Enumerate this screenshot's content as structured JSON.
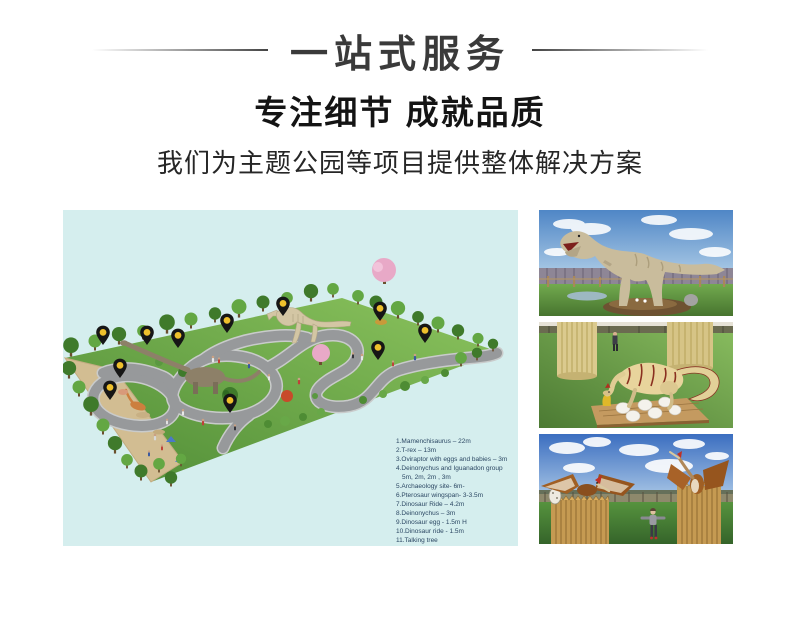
{
  "header": {
    "banner_title": "一站式服务",
    "heading": "专注细节 成就品质",
    "subheading": "我们为主题公园等项目提供整体解决方案"
  },
  "park_map": {
    "legend_items": [
      "1.Mamenchisaurus – 22m",
      "2.T-rex – 13m",
      "3.Oviraptor with eggs and babies – 3m",
      "4.Deinonychus and Iguanadon group",
      "5m, 2m, 2m , 3m",
      "5.Archaeology site- 6m-",
      "6.Pterosaur  wingspan- 3-3.5m",
      "7.Dinosaur Ride – 4.2m",
      "8.Deinonychus – 3m",
      "9.Dinosaur egg - 1.5m H",
      "10.Dinosaur ride -  1.5m",
      "11.Talking tree"
    ],
    "pin_count": 11,
    "colors": {
      "background": "#d5eeee",
      "grass_light": "#8cc45e",
      "grass_dark": "#4f8c36",
      "path": "#97999b",
      "sand": "#d2bd92",
      "pin": "#161616",
      "pin_dot": "#eec02c",
      "legend_text": "#2b4763"
    }
  },
  "photos": {
    "trex": "t-rex-model-photo",
    "eggs": "dinosaur-eggs-photo",
    "pterosaur": "pterosaur-photo"
  }
}
